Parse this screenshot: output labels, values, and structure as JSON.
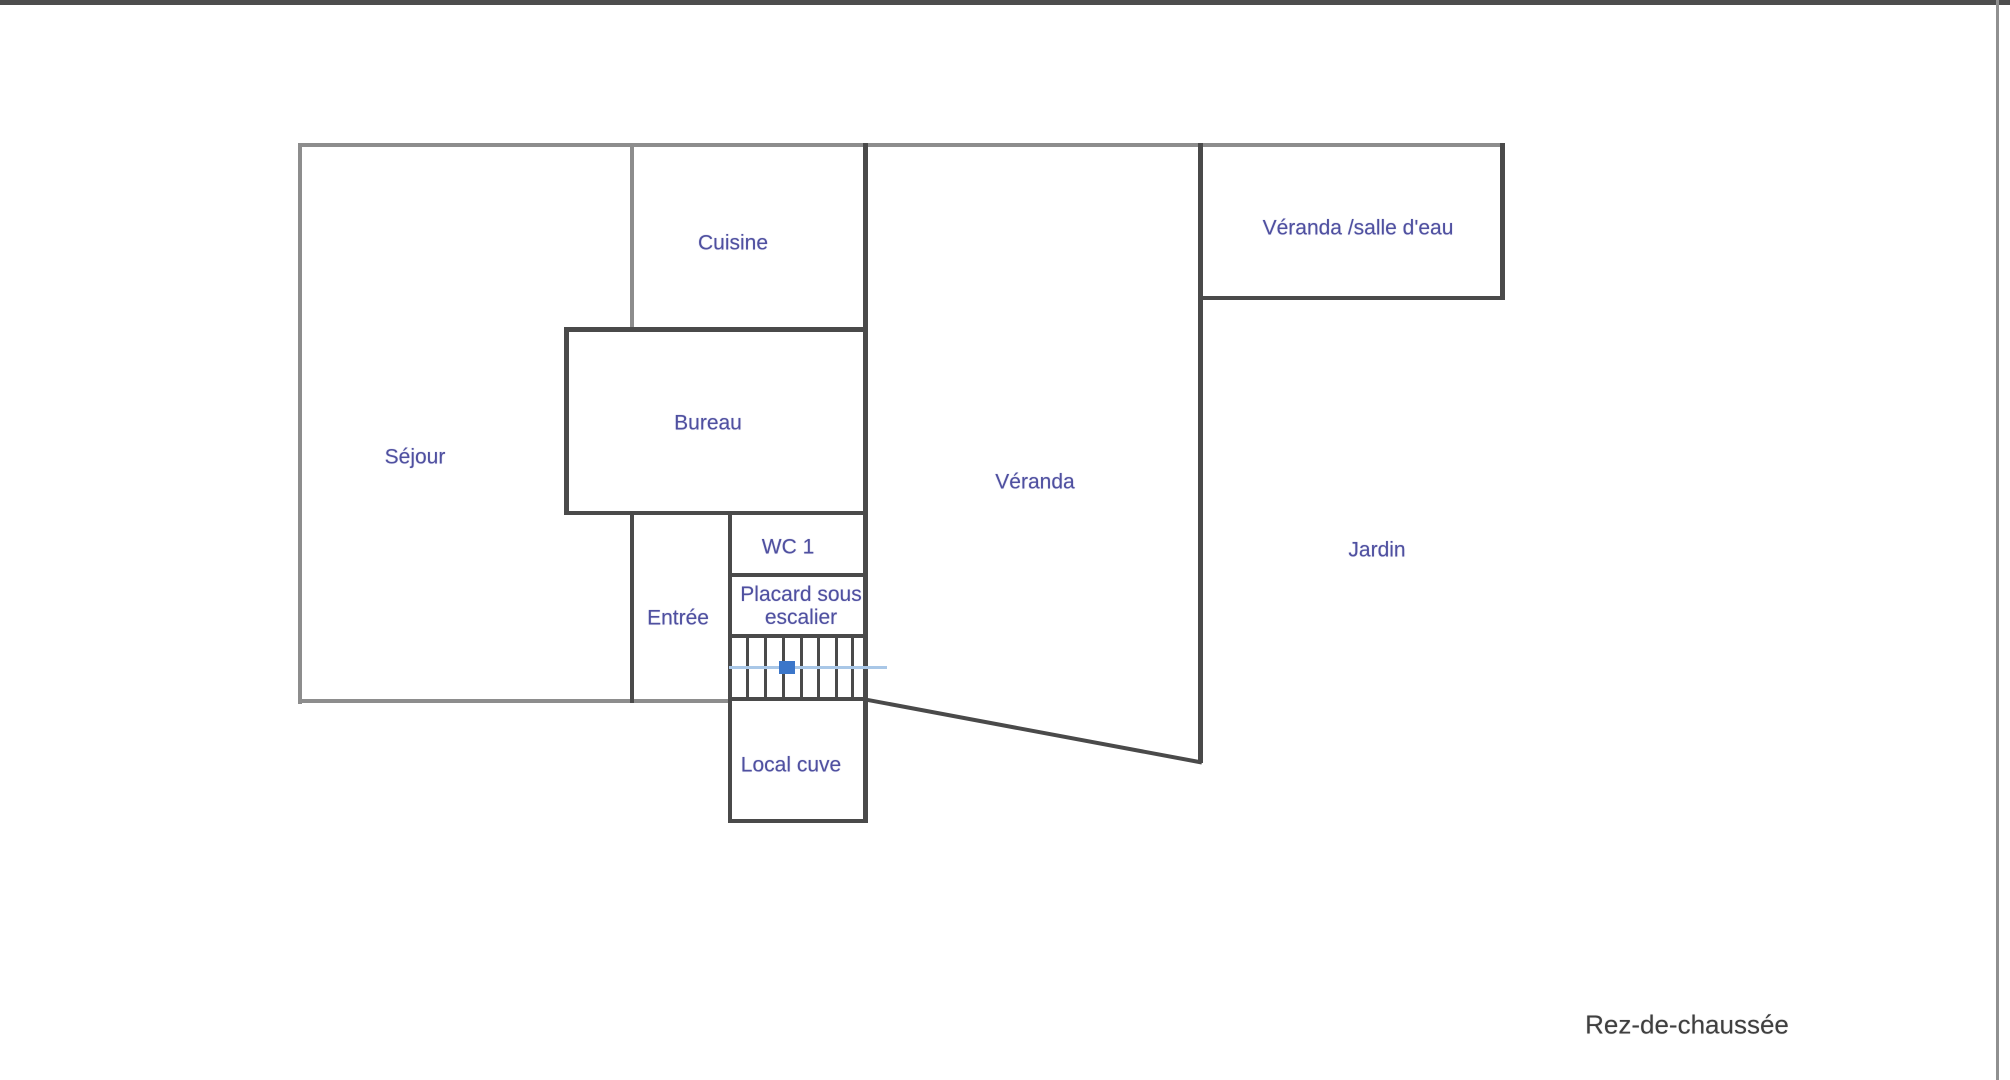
{
  "floor_label": "Rez-de-chaussée",
  "colors": {
    "background": "#ffffff",
    "top_bar": "#4d4d4d",
    "right_border": "#909090",
    "wall_light": "#8d8d8d",
    "wall_dark": "#4a4a4a",
    "label_blue": "#4f50a0",
    "footer_text": "#3f3f3f",
    "stair_line_blue": "#a9c7e7",
    "stair_marker_blue": "#3b76c9"
  },
  "rooms": [
    {
      "id": "sejour",
      "label": "Séjour",
      "cx": 415,
      "cy": 457
    },
    {
      "id": "cuisine",
      "label": "Cuisine",
      "cx": 733,
      "cy": 243
    },
    {
      "id": "bureau",
      "label": "Bureau",
      "cx": 708,
      "cy": 423
    },
    {
      "id": "wc-1",
      "label": "WC 1",
      "cx": 788,
      "cy": 547
    },
    {
      "id": "entree",
      "label": "Entrée",
      "cx": 678,
      "cy": 618
    },
    {
      "id": "placard",
      "label": "Placard sous escalier",
      "cx": 801,
      "cy": 606,
      "wrap": 132
    },
    {
      "id": "local-cuve",
      "label": "Local cuve",
      "cx": 791,
      "cy": 765
    },
    {
      "id": "veranda",
      "label": "Véranda",
      "cx": 1035,
      "cy": 482
    },
    {
      "id": "veranda-salle-deau",
      "label": "Véranda /salle d'eau",
      "cx": 1358,
      "cy": 228
    },
    {
      "id": "jardin",
      "label": "Jardin",
      "cx": 1377,
      "cy": 550
    }
  ],
  "walls": [
    {
      "name": "wall-outer-top",
      "x": 298,
      "y": 143,
      "w": 1207,
      "h": 4,
      "shade": "light"
    },
    {
      "name": "wall-outer-left",
      "x": 298,
      "y": 143,
      "w": 4,
      "h": 561,
      "shade": "light"
    },
    {
      "name": "wall-sejour-bottom",
      "x": 298,
      "y": 699,
      "w": 434,
      "h": 4,
      "shade": "light"
    },
    {
      "name": "wall-cuisine-left",
      "x": 630,
      "y": 143,
      "w": 4,
      "h": 188,
      "shade": "light"
    },
    {
      "name": "wall-bureau-top",
      "x": 564,
      "y": 327,
      "w": 303,
      "h": 5,
      "shade": "dark"
    },
    {
      "name": "wall-bureau-left",
      "x": 564,
      "y": 327,
      "w": 5,
      "h": 188,
      "shade": "dark"
    },
    {
      "name": "wall-bureau-bottom",
      "x": 564,
      "y": 511,
      "w": 303,
      "h": 4,
      "shade": "dark"
    },
    {
      "name": "wall-entree-left",
      "x": 630,
      "y": 511,
      "w": 4,
      "h": 192,
      "shade": "dark"
    },
    {
      "name": "wall-east",
      "x": 863,
      "y": 143,
      "w": 5,
      "h": 680,
      "shade": "dark"
    },
    {
      "name": "wall-wc-left",
      "x": 728,
      "y": 511,
      "w": 4,
      "h": 312,
      "shade": "dark"
    },
    {
      "name": "wall-wc-bottom",
      "x": 728,
      "y": 573,
      "w": 140,
      "h": 4,
      "shade": "dark"
    },
    {
      "name": "wall-stairs-top",
      "x": 728,
      "y": 634,
      "w": 140,
      "h": 4,
      "shade": "dark"
    },
    {
      "name": "wall-stairs-bottom",
      "x": 728,
      "y": 697,
      "w": 140,
      "h": 4,
      "shade": "dark"
    },
    {
      "name": "wall-local-cuve-bottom",
      "x": 728,
      "y": 819,
      "w": 140,
      "h": 4,
      "shade": "dark"
    },
    {
      "name": "wall-veranda-right",
      "x": 1198,
      "y": 143,
      "w": 5,
      "h": 620,
      "shade": "dark"
    },
    {
      "name": "wall-salle-deau-right",
      "x": 1500,
      "y": 143,
      "w": 5,
      "h": 157,
      "shade": "dark"
    },
    {
      "name": "wall-salle-deau-bottom",
      "x": 1198,
      "y": 296,
      "w": 307,
      "h": 4,
      "shade": "dark"
    }
  ],
  "diagonal_wall": {
    "x": 868,
    "y": 698,
    "length": 340,
    "angle_deg": 10.6,
    "thickness": 3.5
  },
  "stairs": {
    "tread_x": [
      746,
      764,
      782,
      800,
      817,
      835,
      851
    ],
    "tread_top": 637,
    "tread_height": 60,
    "tread_width": 2.5,
    "direction_line": {
      "x": 729,
      "y": 666,
      "w": 158,
      "h": 3
    },
    "marker": {
      "x": 779,
      "y": 661,
      "w": 16,
      "h": 13
    }
  },
  "footer_pos": {
    "cx": 1687,
    "cy": 1025
  }
}
